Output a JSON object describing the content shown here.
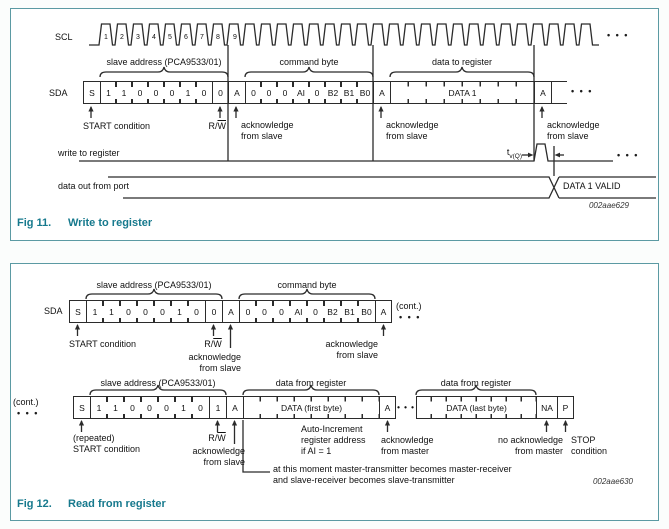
{
  "shared": {
    "sda_label": "SDA",
    "s": "S",
    "ack": "A",
    "addr_bits": [
      "1",
      "1",
      "0",
      "0",
      "0",
      "1",
      "0"
    ],
    "cmd_bits": [
      "0",
      "0",
      "0",
      "AI",
      "0",
      "B2",
      "B1",
      "B0"
    ],
    "rw_pre": "R/",
    "rw_bar": "W",
    "ack_slave": "acknowledge\nfrom slave",
    "start_condition": "START condition",
    "slave_address_brace": "slave address (PCA9533/01)",
    "command_byte_brace": "command byte",
    "dots": "• • •",
    "cont": "(cont.)"
  },
  "colors": {
    "caption_teal": "#16798d",
    "panel_border": "#5b9aa3",
    "line": "#2b2b2b"
  },
  "fig11": {
    "scl_label": "SCL",
    "clock_numbers": [
      "1",
      "2",
      "3",
      "4",
      "5",
      "6",
      "7",
      "8",
      "9"
    ],
    "rw_bit": "0",
    "data_cell": "DATA 1",
    "data_to_register_brace": "data to register",
    "write_to_register": "write to register",
    "data_out_from_port": "data out from port",
    "tv_t": "t",
    "tv_sub": "v(Q)",
    "data_valid": "DATA 1 VALID",
    "code": "002aae629",
    "caption_fig": "Fig 11.",
    "caption_title": "Write to register"
  },
  "fig12": {
    "rw_bit_write": "0",
    "rw_bit_read": "1",
    "data_first": "DATA (first byte)",
    "data_last": "DATA (last byte)",
    "nack": "NA",
    "stop_bit": "P",
    "data_from_register_brace": "data from register",
    "repeated_start": "(repeated)\nSTART condition",
    "auto_increment": "Auto-Increment\nregister address\nif AI = 1",
    "ack_master": "acknowledge\nfrom master",
    "no_ack_master": "no acknowledge\nfrom master",
    "stop_condition": "STOP\ncondition",
    "moment_note": "at this moment master-transmitter becomes master-receiver\nand slave-receiver becomes slave-transmitter",
    "code": "002aae630",
    "caption_fig": "Fig 12.",
    "caption_title": "Read from register"
  }
}
